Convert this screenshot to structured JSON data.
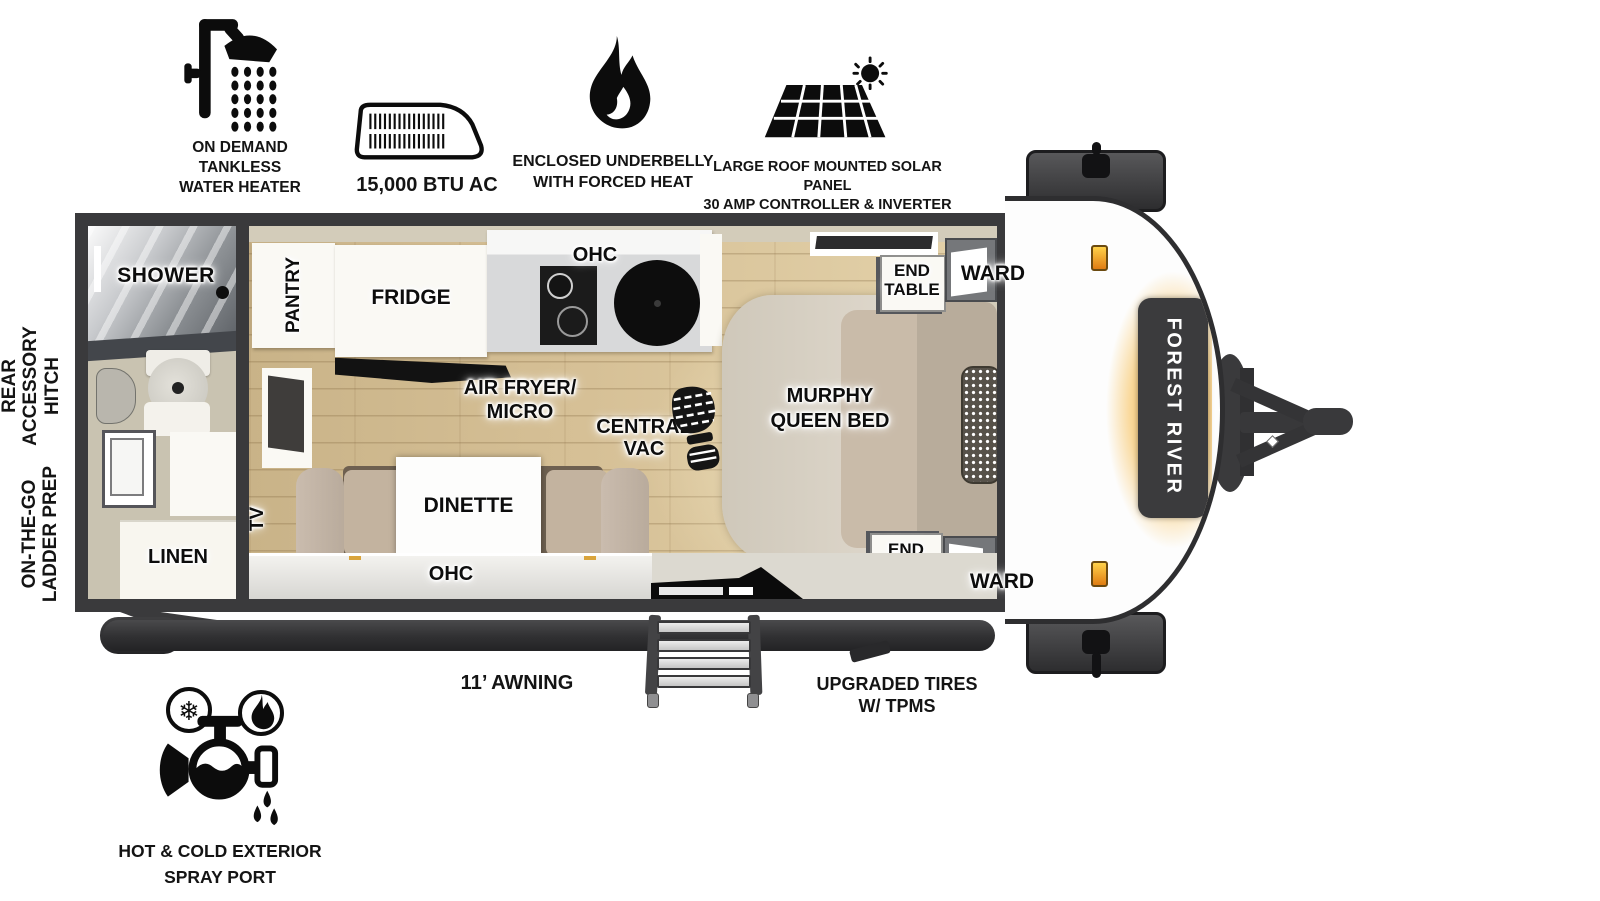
{
  "brand": {
    "label": "FOREST RIVER"
  },
  "callouts": {
    "water_heater": {
      "lines": [
        "ON DEMAND",
        "TANKLESS",
        "WATER HEATER"
      ]
    },
    "ac": {
      "label": "15,000 BTU AC"
    },
    "underbelly": {
      "lines": [
        "ENCLOSED UNDERBELLY",
        "WITH FORCED HEAT"
      ]
    },
    "solar": {
      "lines": [
        "LARGE ROOF MOUNTED SOLAR PANEL",
        "30 AMP CONTROLLER & INVERTER PREP"
      ]
    },
    "rear_hitch": {
      "lines": [
        "REAR",
        "ACCESSORY",
        "HITCH"
      ]
    },
    "ladder": {
      "lines": [
        "ON-THE-GO",
        "LADDER PREP"
      ]
    },
    "awning": {
      "label": "11’ AWNING"
    },
    "tires": {
      "lines": [
        "UPGRADED TIRES",
        "W/ TPMS"
      ]
    },
    "spray_port": {
      "lines": [
        "HOT & COLD EXTERIOR",
        "SPRAY PORT"
      ]
    }
  },
  "plan": {
    "shower": "SHOWER",
    "linen": "LINEN",
    "pantry": "PANTRY",
    "fridge": "FRIDGE",
    "ohc_kitchen": "OHC",
    "air_fryer_micro": {
      "lines": [
        "AIR FRYER/",
        "MICRO"
      ]
    },
    "central_vac": {
      "lines": [
        "CENTRAL",
        "VAC"
      ]
    },
    "dinette": "DINETTE",
    "tv": "TV",
    "ohc_dinette": "OHC",
    "murphy_bed": {
      "lines": [
        "MURPHY",
        "QUEEN BED"
      ]
    },
    "end_table_top": {
      "lines": [
        "END",
        "TABLE"
      ]
    },
    "ward_top": "WARD",
    "end_table_bottom": {
      "lines": [
        "END",
        "TABLE"
      ]
    },
    "ward_bottom": "WARD"
  },
  "colors": {
    "wall": "#3a3a3c",
    "wood_floor": "#d9c499",
    "accent_orange": "#f2a93b"
  }
}
